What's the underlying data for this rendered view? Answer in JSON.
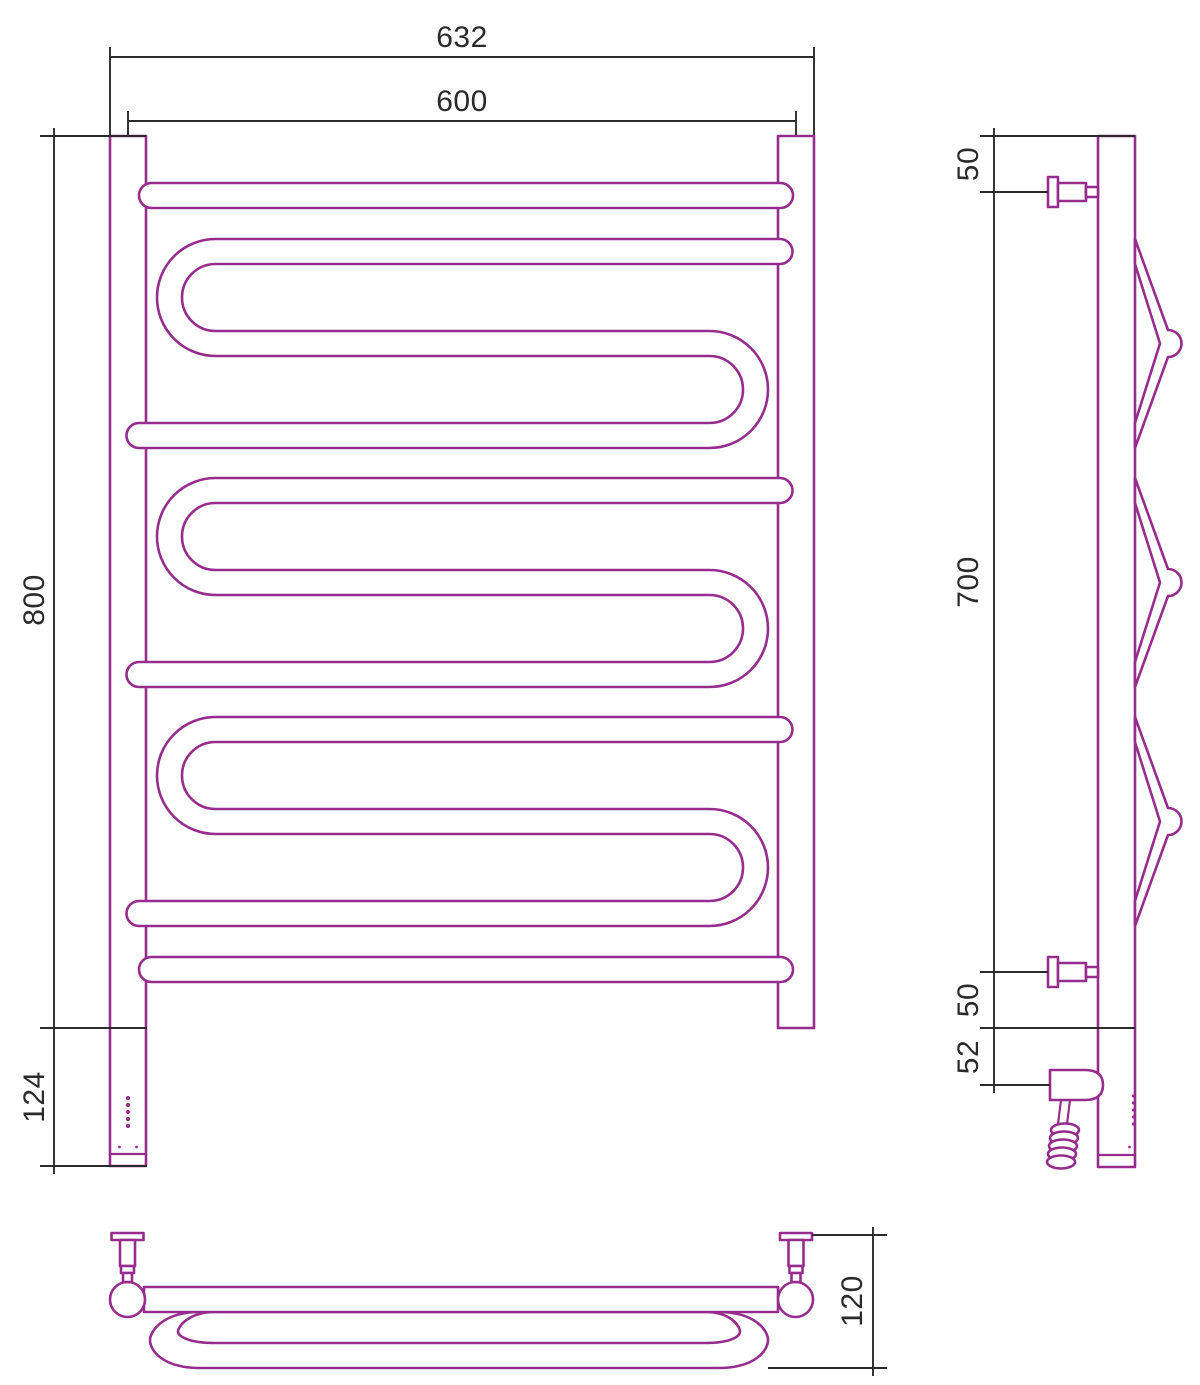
{
  "drawing": {
    "kind": "technical-drawing",
    "subject": "heated towel rail, three orthographic views",
    "colors": {
      "line": "#962d8c",
      "dimension": "#2b2b2b",
      "background": "#ffffff"
    }
  },
  "views": {
    "front": {
      "dims": {
        "overall_width": "632",
        "axis_width": "600",
        "height": "800",
        "heater_height": "124"
      }
    },
    "side": {
      "dims": {
        "top_offset": "50",
        "bracket_span": "700",
        "bottom_offset": "50",
        "heater_offset": "52"
      }
    },
    "plan": {
      "dims": {
        "depth": "120"
      }
    }
  }
}
